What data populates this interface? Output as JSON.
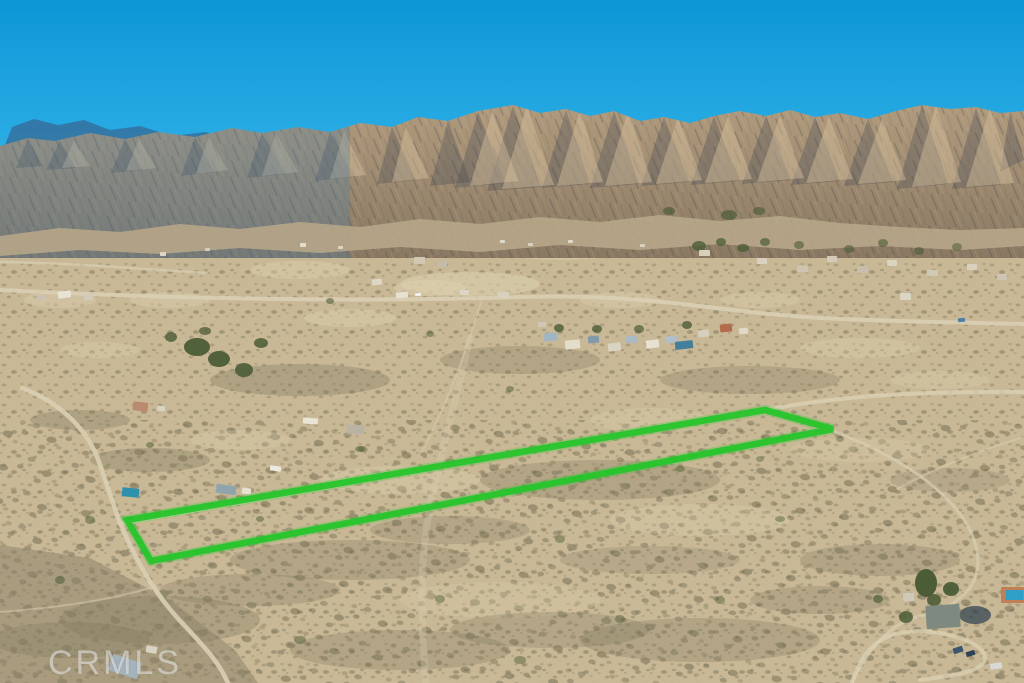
{
  "meta": {
    "kind": "aerial-drone-photograph",
    "description": "Aerial real-estate listing photo of a high-desert valley with a rugged mountain range under a clear blue sky; a long narrow vacant-land parcel is outlined in bright green; scattered rural homes, dirt roads and desert scrub fill the valley; CRMLS watermark at bottom left."
  },
  "watermark": {
    "text": "CRMLS"
  },
  "palette": {
    "sky_top": "#0d96d6",
    "sky_horizon": "#35b5ea",
    "far_ridge_blue": "#35719f",
    "mountain_top": "#b19b7d",
    "mountain_bottom": "#8a7862",
    "mountain_haze": "#3f7cab",
    "ridge_shadow": "#3e4553",
    "ridge_light": "#d7c19d",
    "foothills": "#b7a688",
    "valley_base": "#c9b896",
    "sand_light": "#dbcfae",
    "scrub_dark": "#7f785e",
    "foreground_slope": "#8a7f66",
    "dirt_road": "#d9cfb2",
    "tree_green": "#4b5c36",
    "shadow_water": "#2b3f4e",
    "outline_green": "#26c52b"
  },
  "property_outline": {
    "points": "127,520 765,410 833,429 151,561",
    "stroke": "#26c52b",
    "stroke_width": 6.5,
    "glow_width": 10
  },
  "terrain": {
    "far_ridge": "0,158 12,127 34,119 58,125 84,120 110,130 140,126 172,136 205,132 240,142 278,149 318,157 352,164 352,205 0,205",
    "main_ridge": "0,146 28,138 55,141 90,133 125,139 158,132 195,137 232,128 262,133 298,127 330,132 360,123 392,127 418,117 448,121 478,111 513,105 540,113 566,109 590,116 614,111 640,121 664,117 690,123 714,116 740,111 766,116 790,110 815,117 840,113 868,119 896,111 922,105 950,109 976,107 1000,113 1024,111 1024,258 0,258",
    "foothills": "0,236 60,228 120,232 180,224 240,229 300,222 360,227 420,219 480,224 540,217 600,222 660,215 720,221 780,216 840,223 900,227 960,230 1024,228 1024,246 960,250 880,246 800,250 720,244 640,250 560,245 480,252 400,247 320,253 240,248 160,254 80,250 0,256",
    "shadow_facets": [
      "28,138 42,166 16,168",
      "60,141 76,168 46,170",
      "125,139 143,170 111,173",
      "195,137 215,172 181,176",
      "262,133 285,174 247,178",
      "330,132 353,177 315,181",
      "392,127 416,180 377,184",
      "448,121 470,182 430,186",
      "478,112 506,183 455,188",
      "513,106 541,187 487,191",
      "566,110 590,184 542,188",
      "614,111 639,184 590,188",
      "664,117 689,182 641,186",
      "714,116 739,181 691,185",
      "766,116 791,180 742,184",
      "815,117 840,181 791,185",
      "868,119 893,182 844,186",
      "922,105 948,184 897,189",
      "976,108 1001,185 952,189",
      "1010,112 1024,160 1000,172"
    ],
    "light_facets": [
      "74,141 90,166 62,168",
      "139,139 156,168 126,171",
      "209,137 228,170 196,174",
      "276,133 298,172 262,176",
      "344,132 366,175 330,179",
      "406,127 429,178 392,182",
      "492,112 519,181 470,186",
      "527,106 554,185 502,189",
      "580,110 603,182 557,186",
      "628,111 652,182 605,186",
      "678,117 702,180 656,184",
      "728,116 752,179 705,183",
      "780,116 804,178 757,182",
      "829,117 853,179 806,183",
      "882,119 906,180 858,184",
      "936,105 961,182 912,187",
      "990,108 1014,183 966,187"
    ],
    "foreground_slope": "0,545 90,558 170,600 235,650 258,683 0,683"
  },
  "desert": {
    "sand_patches": [
      [
        470,
        284,
        70,
        12,
        0.6
      ],
      [
        560,
        250,
        60,
        10,
        0.5
      ],
      [
        350,
        318,
        46,
        9,
        0.45
      ],
      [
        620,
        300,
        40,
        8,
        0.4
      ],
      [
        170,
        300,
        40,
        8,
        0.4
      ],
      [
        860,
        348,
        60,
        10,
        0.35
      ],
      [
        400,
        480,
        80,
        14,
        0.35
      ],
      [
        650,
        420,
        60,
        12,
        0.3
      ],
      [
        240,
        440,
        50,
        10,
        0.3
      ],
      [
        700,
        520,
        90,
        16,
        0.3
      ],
      [
        500,
        600,
        100,
        18,
        0.28
      ],
      [
        860,
        450,
        70,
        12,
        0.28
      ],
      [
        300,
        270,
        50,
        9,
        0.45
      ],
      [
        430,
        288,
        36,
        8,
        0.5
      ],
      [
        760,
        300,
        40,
        8,
        0.35
      ],
      [
        940,
        380,
        50,
        9,
        0.3
      ],
      [
        100,
        350,
        40,
        8,
        0.35
      ],
      [
        60,
        300,
        36,
        8,
        0.4
      ]
    ],
    "scrub_patches": [
      [
        300,
        380,
        90,
        16,
        0.35
      ],
      [
        520,
        360,
        80,
        14,
        0.3
      ],
      [
        750,
        380,
        90,
        14,
        0.3
      ],
      [
        150,
        460,
        60,
        12,
        0.35
      ],
      [
        600,
        480,
        120,
        20,
        0.3
      ],
      [
        880,
        560,
        80,
        16,
        0.3
      ],
      [
        350,
        560,
        120,
        20,
        0.3
      ],
      [
        160,
        620,
        100,
        24,
        0.35
      ],
      [
        700,
        640,
        120,
        22,
        0.3
      ],
      [
        950,
        480,
        60,
        12,
        0.25
      ],
      [
        80,
        420,
        50,
        10,
        0.35
      ],
      [
        450,
        530,
        80,
        14,
        0.28
      ],
      [
        250,
        590,
        90,
        16,
        0.3
      ],
      [
        550,
        630,
        100,
        18,
        0.28
      ],
      [
        820,
        600,
        70,
        14,
        0.28
      ],
      [
        400,
        650,
        110,
        20,
        0.3
      ],
      [
        650,
        560,
        90,
        14,
        0.25
      ],
      [
        70,
        640,
        80,
        18,
        0.35
      ]
    ],
    "shadow_pools": [
      [
        975,
        615,
        16,
        9,
        0.7
      ]
    ]
  },
  "roads": [
    {
      "name": "paved-road",
      "d": "M0,290 C180,299 360,302 520,297 C660,293 720,314 840,319 C920,322 980,323 1024,324",
      "w": 4,
      "o": 0.9
    },
    {
      "name": "dirt-road",
      "d": "M0,262 C70,263 130,268 205,273",
      "w": 2.5,
      "o": 0.7
    },
    {
      "name": "frontage-road",
      "d": "M120,524 C340,486 560,448 770,409 C830,398 900,391 1024,392",
      "w": 4,
      "o": 0.85
    },
    {
      "name": "dirt-road",
      "d": "M22,388 C60,402 88,430 99,462 C112,498 117,520 132,549 C148,582 166,607 186,627 C202,645 218,660 228,683",
      "w": 4.5,
      "o": 0.9
    },
    {
      "name": "dirt-road",
      "d": "M150,588 C110,600 55,608 0,612",
      "w": 2,
      "o": 0.5
    },
    {
      "name": "dirt-road",
      "d": "M833,431 C880,449 922,472 950,502 C974,528 984,556 974,581 C964,601 940,612 920,616 C898,621 872,640 852,683",
      "w": 3,
      "o": 0.7
    },
    {
      "name": "driveway-loop",
      "d": "M852,683 C860,655 875,640 895,634 C930,625 985,640 985,658 C985,672 950,676 920,680",
      "w": 4,
      "o": 0.8
    },
    {
      "name": "trail",
      "d": "M1024,437 C975,452 935,468 897,489",
      "w": 2,
      "o": 0.5
    },
    {
      "name": "trail",
      "d": "M482,298 C473,330 462,362 448,396 C441,413 432,432 422,452",
      "w": 2,
      "o": 0.45
    },
    {
      "name": "sandy-wash",
      "d": "M470,338 C456,400 441,452 431,502 C421,552 419,602 426,683",
      "w": 7,
      "o": 0.3
    }
  ],
  "trees": [
    [
      197,
      347,
      13,
      9,
      0.95
    ],
    [
      219,
      359,
      11,
      8,
      0.95
    ],
    [
      244,
      370,
      9,
      7,
      0.9
    ],
    [
      261,
      343,
      7,
      5,
      0.85
    ],
    [
      171,
      337,
      6,
      5,
      0.8
    ],
    [
      205,
      331,
      6,
      4,
      0.75
    ],
    [
      559,
      328,
      5,
      4,
      0.8
    ],
    [
      597,
      329,
      5,
      4,
      0.8
    ],
    [
      639,
      329,
      5,
      4,
      0.7
    ],
    [
      687,
      325,
      5,
      4,
      0.8
    ],
    [
      699,
      246,
      7,
      5,
      0.8
    ],
    [
      721,
      242,
      5,
      4,
      0.75
    ],
    [
      743,
      248,
      6,
      4,
      0.8
    ],
    [
      765,
      242,
      5,
      4,
      0.7
    ],
    [
      669,
      211,
      6,
      4,
      0.7
    ],
    [
      729,
      215,
      8,
      5,
      0.7
    ],
    [
      759,
      211,
      6,
      4,
      0.65
    ],
    [
      799,
      245,
      5,
      4,
      0.6
    ],
    [
      849,
      249,
      5,
      4,
      0.6
    ],
    [
      883,
      243,
      5,
      4,
      0.6
    ],
    [
      919,
      251,
      5,
      4,
      0.6
    ],
    [
      957,
      247,
      5,
      4,
      0.55
    ],
    [
      926,
      583,
      11,
      14,
      1
    ],
    [
      951,
      589,
      8,
      7,
      0.95
    ],
    [
      934,
      600,
      7,
      6,
      0.9
    ],
    [
      906,
      617,
      7,
      6,
      0.85
    ],
    [
      878,
      599,
      5,
      4,
      0.7
    ],
    [
      330,
      301,
      4,
      3,
      0.6
    ],
    [
      430,
      334,
      4,
      3,
      0.5
    ],
    [
      510,
      389,
      4,
      3,
      0.5
    ],
    [
      360,
      449,
      5,
      3,
      0.5
    ],
    [
      680,
      469,
      5,
      3,
      0.45
    ],
    [
      780,
      519,
      5,
      3,
      0.45
    ],
    [
      560,
      539,
      5,
      4,
      0.45
    ],
    [
      260,
      519,
      4,
      3,
      0.5
    ],
    [
      440,
      599,
      5,
      4,
      0.45
    ],
    [
      620,
      619,
      5,
      4,
      0.45
    ],
    [
      840,
      439,
      4,
      3,
      0.4
    ],
    [
      760,
      459,
      4,
      3,
      0.4
    ],
    [
      150,
      445,
      4,
      3,
      0.5
    ],
    [
      90,
      520,
      5,
      4,
      0.5
    ],
    [
      60,
      580,
      5,
      4,
      0.55
    ],
    [
      300,
      640,
      6,
      4,
      0.5
    ],
    [
      520,
      660,
      6,
      4,
      0.45
    ],
    [
      720,
      600,
      5,
      4,
      0.45
    ]
  ],
  "buildings": [
    [
      58,
      291,
      13,
      7,
      -8,
      "#e9e3d3"
    ],
    [
      84,
      294,
      9,
      6,
      -8,
      "#d2cbbb"
    ],
    [
      38,
      295,
      8,
      5,
      0,
      "#c9c2b0"
    ],
    [
      300,
      243,
      6,
      4,
      0,
      "#e3ddcd"
    ],
    [
      338,
      246,
      5,
      3,
      0,
      "#ddd6c4"
    ],
    [
      500,
      240,
      5,
      3,
      0,
      "#e0dac8"
    ],
    [
      528,
      243,
      5,
      3,
      0,
      "#d9d2c0"
    ],
    [
      568,
      240,
      5,
      3,
      0,
      "#e0dac8"
    ],
    [
      640,
      244,
      5,
      3,
      0,
      "#d8d1bf"
    ],
    [
      160,
      252,
      6,
      4,
      0,
      "#ddd6c4"
    ],
    [
      205,
      248,
      5,
      3,
      0,
      "#d6cfbd"
    ],
    [
      372,
      279,
      10,
      6,
      -6,
      "#ded7c5"
    ],
    [
      396,
      292,
      12,
      6,
      -6,
      "#e6e0cf"
    ],
    [
      414,
      257,
      11,
      7,
      0,
      "#d1c8b4"
    ],
    [
      437,
      261,
      10,
      6,
      0,
      "#c4bca8"
    ],
    [
      460,
      290,
      9,
      5,
      0,
      "#dcd5c3"
    ],
    [
      498,
      292,
      11,
      6,
      -4,
      "#d8d1bf"
    ],
    [
      415,
      293,
      6,
      3,
      -4,
      "#f0efe8"
    ],
    [
      544,
      333,
      13,
      8,
      -6,
      "#a0b5c2"
    ],
    [
      565,
      340,
      15,
      9,
      -6,
      "#e3ddcb"
    ],
    [
      588,
      336,
      11,
      7,
      -6,
      "#8199a9"
    ],
    [
      608,
      343,
      13,
      8,
      -6,
      "#d9d3c1"
    ],
    [
      626,
      336,
      11,
      7,
      -6,
      "#aab9c3"
    ],
    [
      646,
      340,
      13,
      8,
      -6,
      "#e7e1d1"
    ],
    [
      666,
      336,
      11,
      7,
      -6,
      "#b2bec8"
    ],
    [
      675,
      341,
      18,
      8,
      -6,
      "#44809b"
    ],
    [
      698,
      330,
      11,
      7,
      -6,
      "#d6cfbc"
    ],
    [
      720,
      324,
      12,
      8,
      -6,
      "#b36c4b"
    ],
    [
      739,
      328,
      9,
      6,
      -6,
      "#dfd9c7"
    ],
    [
      538,
      322,
      8,
      5,
      -6,
      "#cfc7b3"
    ],
    [
      757,
      258,
      10,
      6,
      0,
      "#d9d1bd"
    ],
    [
      797,
      266,
      11,
      6,
      0,
      "#cdc5af"
    ],
    [
      827,
      256,
      10,
      6,
      0,
      "#d3cbb7"
    ],
    [
      857,
      266,
      11,
      7,
      0,
      "#c7bfab"
    ],
    [
      887,
      260,
      10,
      6,
      0,
      "#d9d3bf"
    ],
    [
      927,
      270,
      11,
      6,
      0,
      "#d0c9b5"
    ],
    [
      967,
      264,
      10,
      6,
      0,
      "#d9d1bd"
    ],
    [
      997,
      274,
      10,
      6,
      0,
      "#cdc5b1"
    ],
    [
      900,
      293,
      11,
      7,
      0,
      "#dbd5c3"
    ],
    [
      699,
      250,
      11,
      6,
      0,
      "#d7d0bb"
    ],
    [
      958,
      318,
      7,
      4,
      -4,
      "#4b80ab"
    ],
    [
      133,
      402,
      15,
      9,
      6,
      "#ba8b6f"
    ],
    [
      157,
      406,
      8,
      5,
      6,
      "#d9d3c3"
    ],
    [
      216,
      485,
      20,
      9,
      8,
      "#90a4ae"
    ],
    [
      242,
      488,
      9,
      6,
      8,
      "#e6e1d1"
    ],
    [
      303,
      418,
      15,
      6,
      4,
      "#e9e5d7"
    ],
    [
      347,
      425,
      17,
      9,
      4,
      "#b8b3a5"
    ],
    [
      270,
      466,
      11,
      5,
      8,
      "#edebe0"
    ],
    [
      122,
      488,
      17,
      9,
      6,
      "#2f91ac"
    ],
    [
      110,
      658,
      30,
      17,
      18,
      "#a3b2bc"
    ],
    [
      146,
      646,
      11,
      7,
      10,
      "#d9d3c3"
    ],
    [
      926,
      605,
      34,
      23,
      -4,
      "#7e8a80"
    ],
    [
      903,
      593,
      11,
      8,
      -4,
      "#cfc9b9"
    ],
    [
      1001,
      587,
      23,
      16,
      0,
      "#c08055"
    ],
    [
      1006,
      590,
      17,
      10,
      0,
      "#2e9fc6"
    ],
    [
      953,
      647,
      10,
      6,
      -18,
      "#3d566e"
    ],
    [
      966,
      651,
      9,
      5,
      -18,
      "#2e4257"
    ],
    [
      990,
      663,
      12,
      6,
      -8,
      "#d8d8d4"
    ]
  ]
}
